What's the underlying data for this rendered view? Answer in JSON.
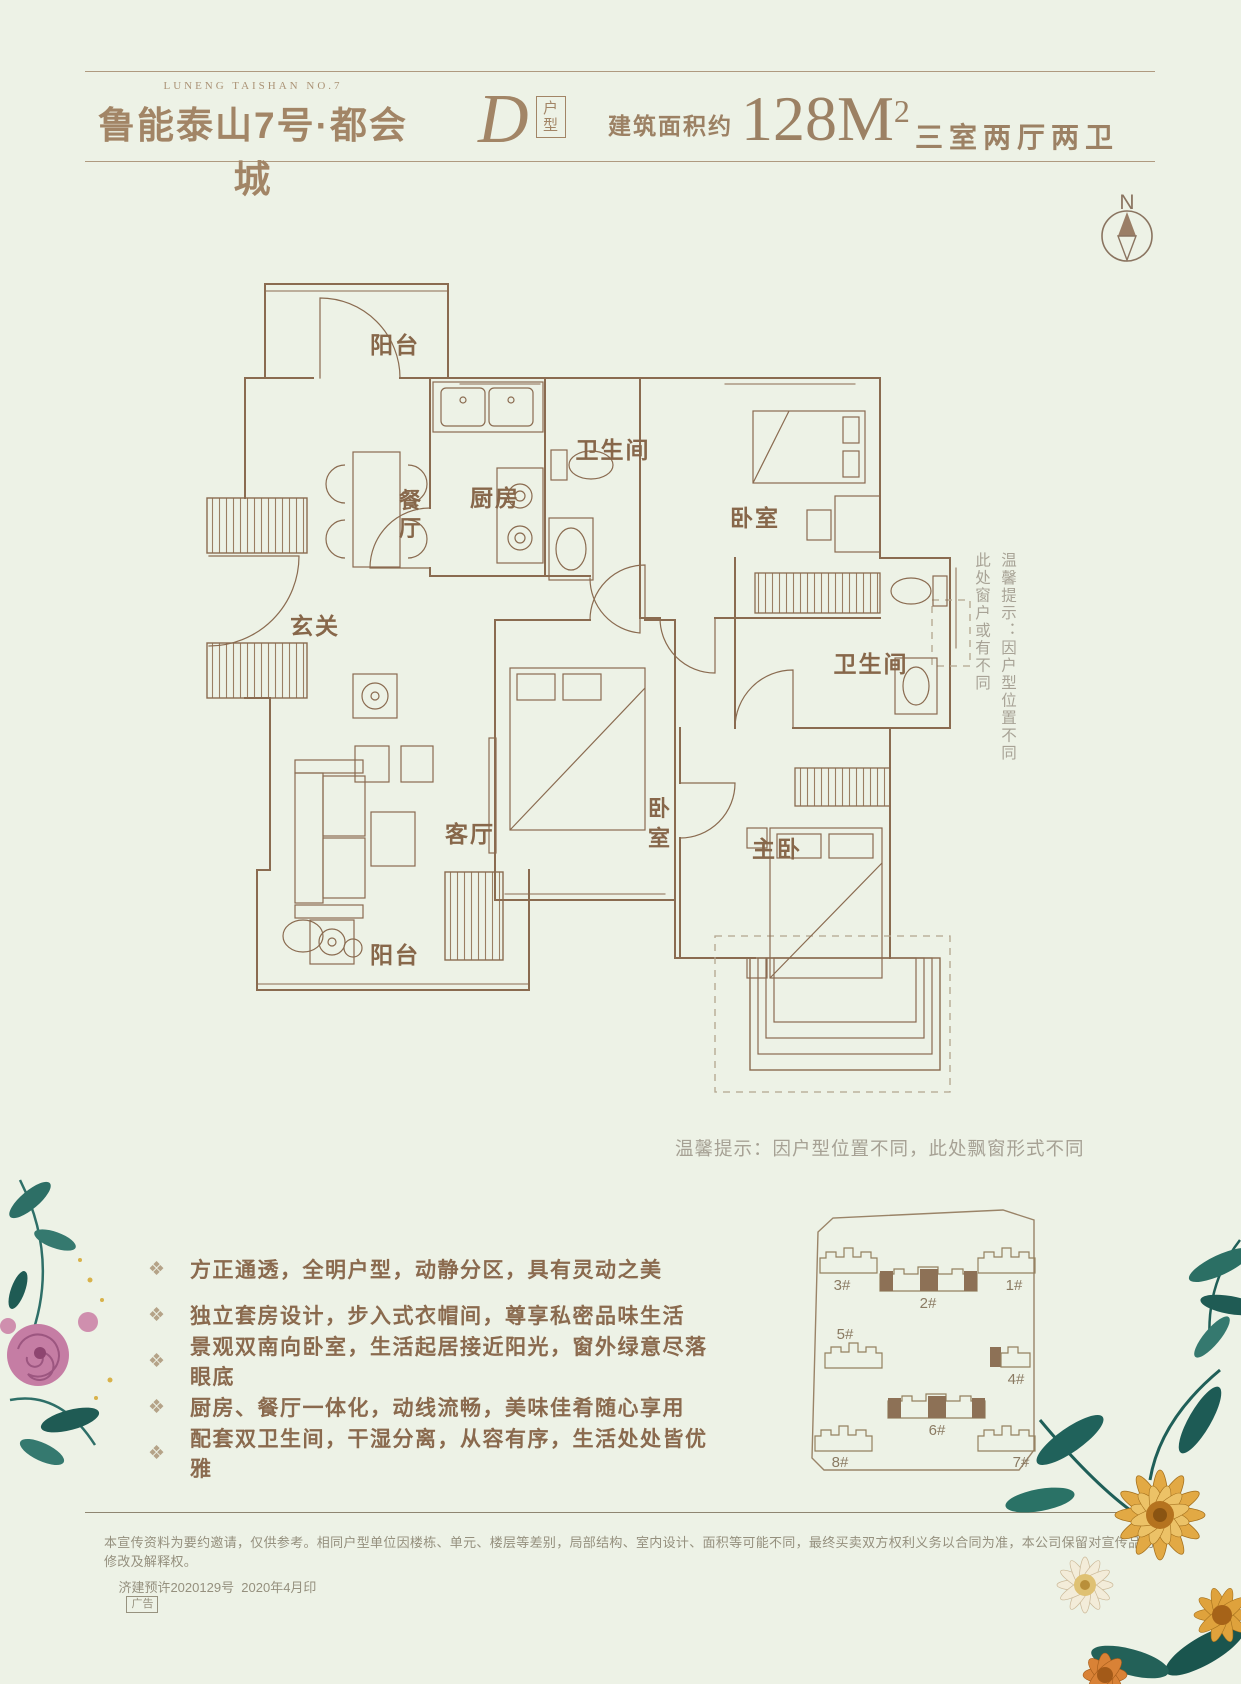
{
  "header": {
    "logo_small": "LUNENG TAISHAN NO.7",
    "logo_main": "鲁能泰山7号·都会城",
    "unit_letter": "D",
    "unit_label_chars": [
      "户",
      "型"
    ],
    "area_prefix": "建筑面积约",
    "area_value": "128M",
    "area_sup": "2",
    "spec": "三室两厅两卫"
  },
  "compass": {
    "label": "N"
  },
  "floorplan": {
    "rooms": {
      "balcony_top": "阳台",
      "dining_chars": [
        "餐",
        "厅"
      ],
      "kitchen": "厨房",
      "bath1": "卫生间",
      "bedroom1": "卧室",
      "entry": "玄关",
      "living": "客厅",
      "bedroom2_chars": [
        "卧",
        "室"
      ],
      "master": "主卧",
      "bath2": "卫生间",
      "balcony_bottom": "阳台"
    },
    "side_note_col1": "温馨提示：因户型位置不同",
    "side_note_col2": "此处窗户或有不同",
    "bottom_note": "温馨提示：因户型位置不同，此处飘窗形式不同"
  },
  "features": {
    "items": [
      "方正通透，全明户型，动静分区，具有灵动之美",
      "独立套房设计，步入式衣帽间，尊享私密品味生活",
      "景观双南向卧室，生活起居接近阳光，窗外绿意尽落眼底",
      "厨房、餐厅一体化，动线流畅，美味佳肴随心享用",
      "配套双卫生间，干湿分离，从容有序，生活处处皆优雅"
    ]
  },
  "siteplan": {
    "buildings": [
      "3#",
      "2#",
      "1#",
      "5#",
      "4#",
      "6#",
      "8#",
      "7#"
    ]
  },
  "footer": {
    "disclaimer": "本宣传资料为要约邀请，仅供参考。相同户型单位因楼栋、单元、楼层等差别，局部结构、室内设计、面积等可能不同，最终买卖双方权利义务以合同为准，本公司保留对宣传品的修改及解释权。",
    "permit": "济建预许2020129号  2020年4月印",
    "ad_tag": "广告"
  },
  "colors": {
    "background": "#edf2e6",
    "plan_line": "#8a6b50",
    "header_brown": "#9c8164",
    "note_gray": "#a6a194",
    "site_fill": "#8d7156"
  }
}
